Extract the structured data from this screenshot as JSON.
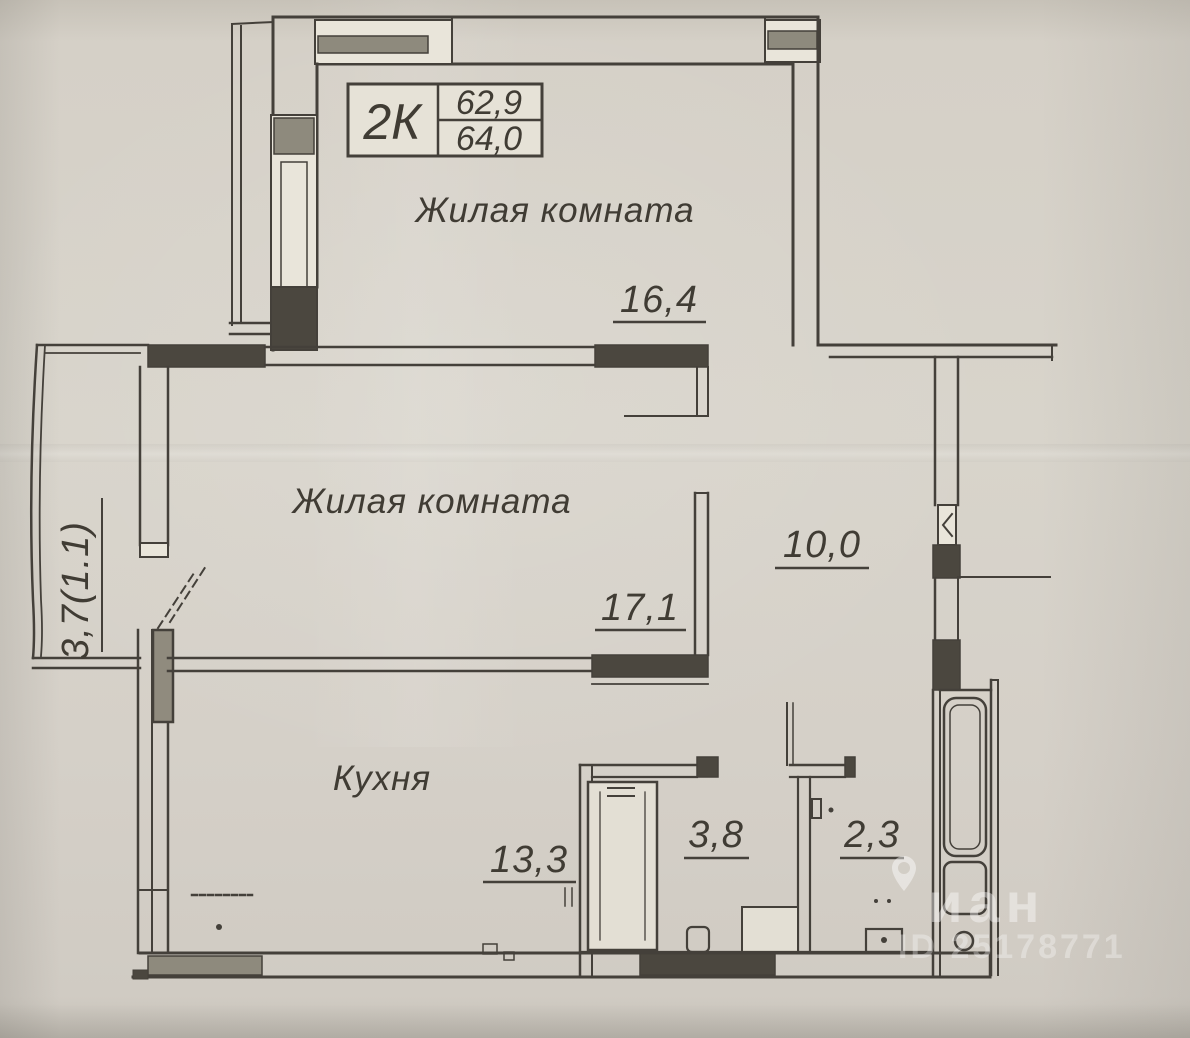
{
  "title_block": {
    "type_label": "2К",
    "area_living": "62,9",
    "area_total": "64,0"
  },
  "rooms": {
    "living_room_1": {
      "label": "Жилая комната",
      "area": "16,4"
    },
    "living_room_2": {
      "label": "Жилая комната",
      "area": "17,1"
    },
    "kitchen": {
      "label": "Кухня",
      "area": "13,3"
    },
    "hallway": {
      "area": "10,0"
    },
    "bathroom": {
      "area": "3,8"
    },
    "toilet": {
      "area": "2,3"
    },
    "balcony": {
      "area": "3,7(1.1)"
    }
  },
  "watermark": {
    "icon": "map-pin-icon",
    "brand_text": "иан",
    "listing_id": "ID 25178771"
  },
  "colors": {
    "paper": "#d6d1c8",
    "ink": "#44403a",
    "wall_fill": "#4b473f",
    "window_band": "#8e8a7d",
    "watermark": "#ffffff"
  }
}
